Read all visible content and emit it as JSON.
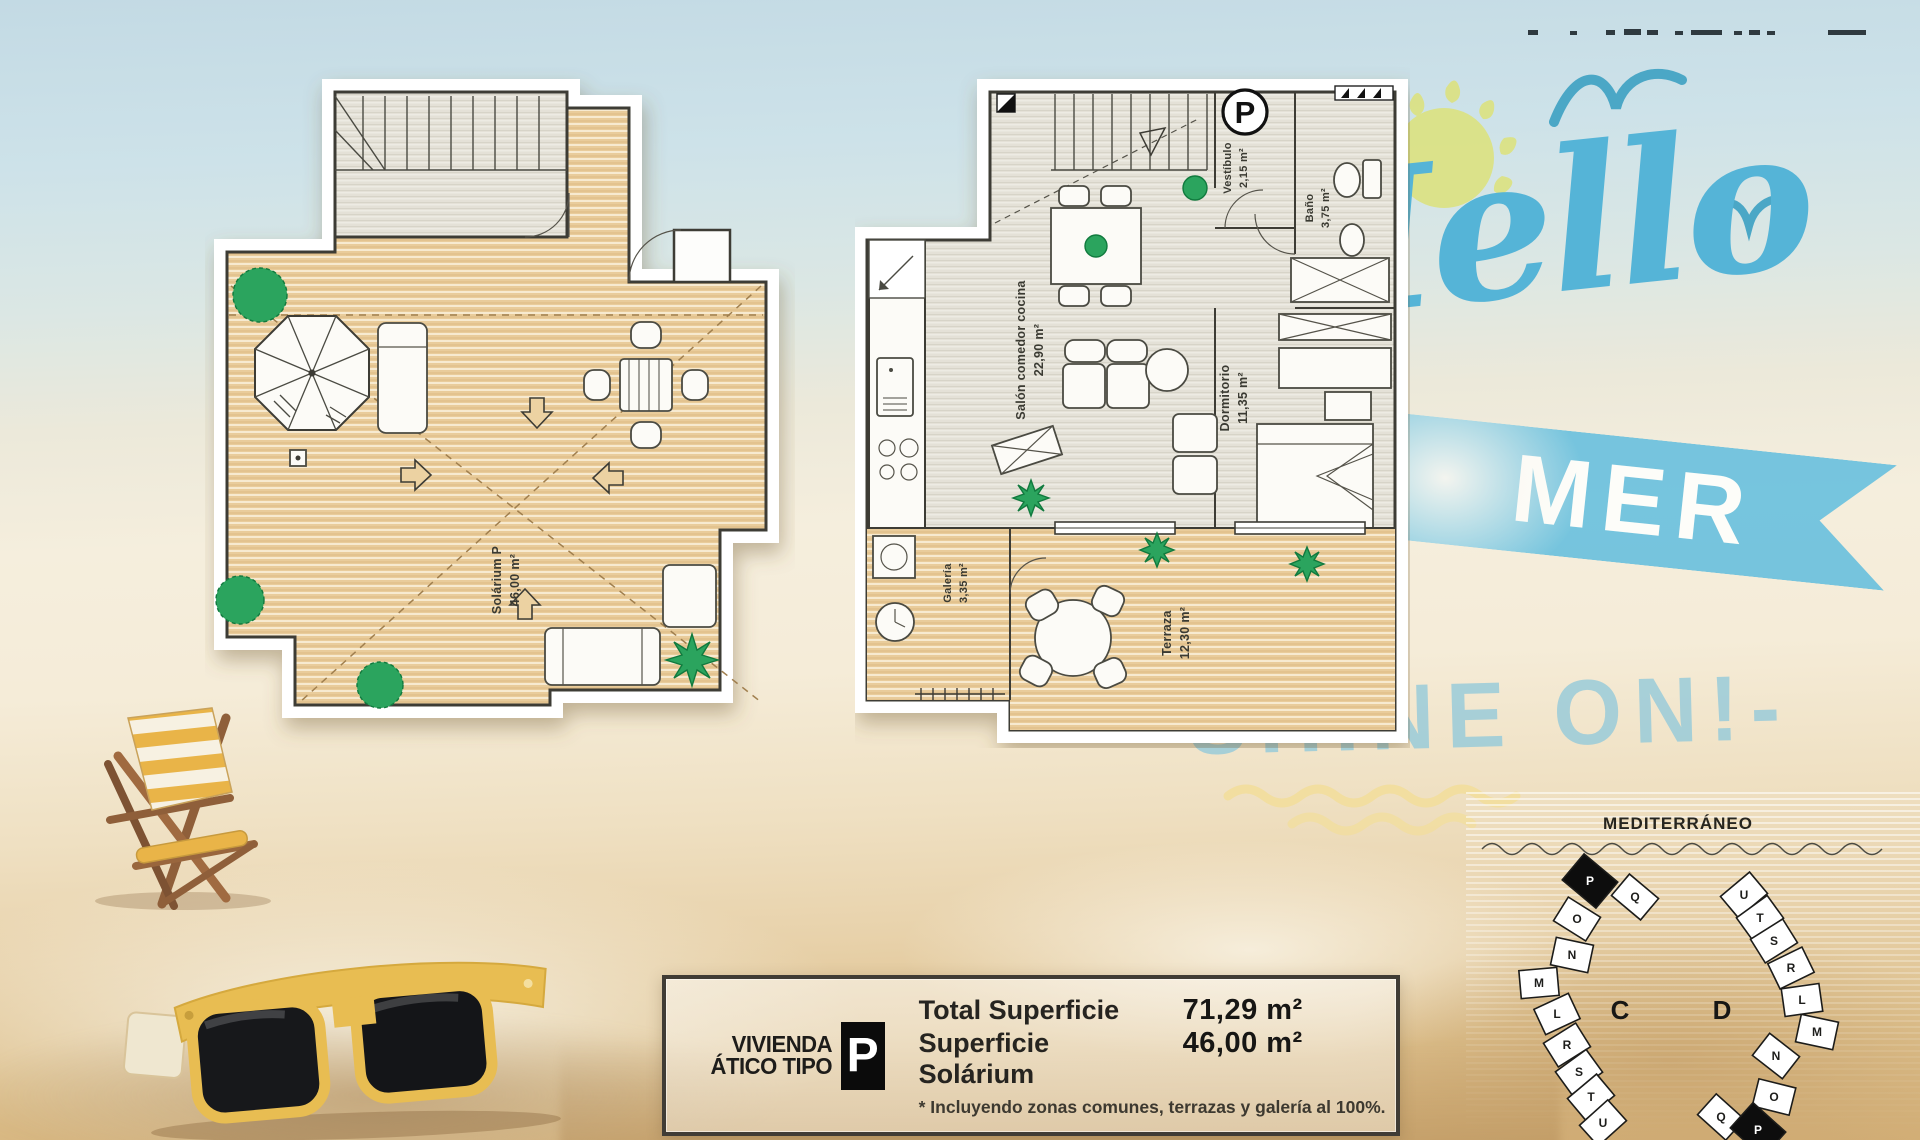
{
  "branding": {
    "hello_script": "Hello",
    "banner_word": "MER",
    "shine_on": "SHINE ON!-"
  },
  "floor_plans": {
    "solarium": {
      "name": "Solárium P",
      "area": "46,00 m²"
    },
    "apartment": {
      "badge": "P",
      "salon": {
        "name": "Salón comedor cocina",
        "area": "22,90 m²"
      },
      "vestibulo": {
        "name": "Vestíbulo",
        "area": "2,15 m²"
      },
      "bano": {
        "name": "Baño",
        "area": "3,75 m²"
      },
      "dormitorio": {
        "name": "Dormitorio",
        "area": "11,35 m²"
      },
      "galeria": {
        "name": "Galería",
        "area": "3,35 m²"
      },
      "terraza": {
        "name": "Terraza",
        "area": "12,30 m²"
      }
    }
  },
  "info_box": {
    "dwelling_line1": "VIVIENDA",
    "dwelling_line2": "ÁTICO TIPO",
    "type_badge": "P",
    "total_label": "Total Superficie",
    "total_value": "71,29 m²",
    "solarium_label": "Superficie Solárium",
    "solarium_value": "46,00 m²",
    "footnote": "* Incluyendo zonas comunes, terrazas y galería al 100%."
  },
  "site_map": {
    "sea_label": "MEDITERRÁNEO",
    "highlighted_unit": "P",
    "cluster_c": {
      "label": "C",
      "units": [
        "P",
        "Q",
        "O",
        "N",
        "M",
        "L",
        "R",
        "S",
        "T",
        "U"
      ]
    },
    "cluster_d": {
      "label": "D",
      "units": [
        "U",
        "T",
        "S",
        "R",
        "L",
        "M",
        "N",
        "O",
        "Q",
        "P"
      ]
    }
  },
  "colors": {
    "accent_blue": "#55b4d7",
    "ribbon_blue": "#6fc2dd",
    "pale_blue_text": "#94c9da",
    "wood_deck": "#e9cc9b",
    "interior_floor": "#e4e1d7",
    "sand": "#e8d2ab",
    "highlight_black": "#0d0d0d"
  }
}
